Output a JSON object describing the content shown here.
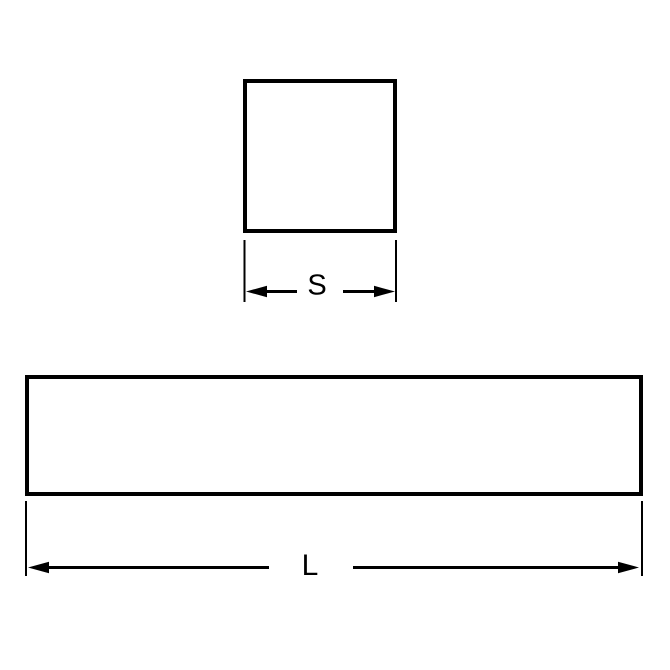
{
  "diagram": {
    "type": "technical-drawing",
    "labels": {
      "square_side": "S",
      "bar_length": "L"
    },
    "colors": {
      "line": "#000000",
      "background": "#ffffff"
    }
  }
}
